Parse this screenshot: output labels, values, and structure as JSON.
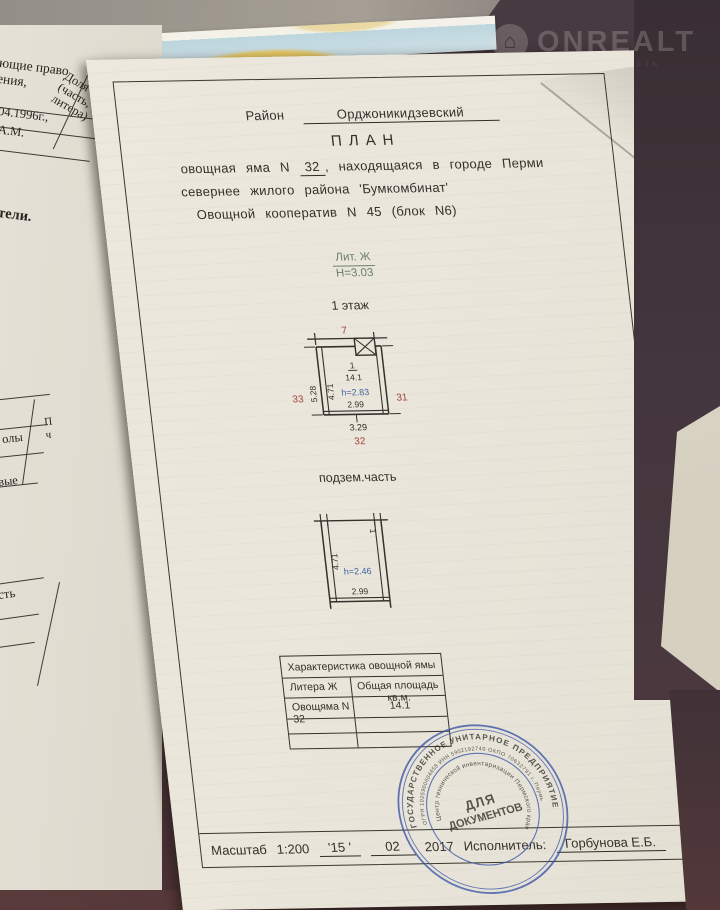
{
  "watermark": {
    "brand": "ONREALT",
    "tagline": "недвижимость",
    "icon": "house-icon"
  },
  "underlay": {
    "f_pravo": "ющие право\nения,",
    "f_dolya": "Доля\n(часть,\nлитера)",
    "f_date": "04.1996г.,",
    "f_am": "А.М.",
    "f_teli": "тели.",
    "f_p": "П\nч",
    "f_oly": "олы",
    "f_vye": "вые",
    "f_st": "сть"
  },
  "doc": {
    "district_label": "Район",
    "district_value": "Орджоникидзевский",
    "title": "ПЛАН",
    "line1_pre": "овощная яма N",
    "line1_num": "32",
    "line1_post": ", находящаяся в городе Перми",
    "line2": "севернее жилого района 'Бумкомбинат'",
    "line3": "Овощной кооператив N 45 (блок N6)",
    "liter": {
      "label": "Лит. Ж",
      "height": "Н=3.03"
    },
    "floor_label": "1 этаж",
    "plan1": {
      "top": "7",
      "left_outer": "5.28",
      "left_inner": "4.71",
      "room": "1",
      "area": "14.1",
      "h": "h=2.83",
      "width_inner": "2.99",
      "width_outer": "3.29",
      "n_left": "33",
      "n_right": "31",
      "n_bottom": "32"
    },
    "underground_label": "подзем.часть",
    "plan2": {
      "room": "1",
      "left": "4.71",
      "h": "h=2.46",
      "width": "2.99"
    },
    "table": {
      "title": "Характеристика овощной ямы",
      "col1": "Литера Ж",
      "col2": "Общая площадь кв.м.",
      "row1_name": "Овощяма N 32",
      "row1_area": "14.1"
    },
    "stamp": {
      "ring_outer": "ГОСУДАРСТВЕННОЕ УНИТАРНОЕ ПРЕДПРИЯТИЕ",
      "ring_numbers": "ОГРН 1025900604658 ИНН 5902192740 ОКПО 70632791 г. Пермь",
      "ring_inner": "Центр технической инвентаризации Пермского края",
      "center1": "ДЛЯ",
      "center2": "ДОКУМЕНТОВ"
    },
    "footer": {
      "scale_label": "Масштаб",
      "scale": "1:200",
      "day": "'15 '",
      "month": "02",
      "year": "2017",
      "executor_label": "Исполнитель:",
      "executor": "Горбунова Е.Б."
    }
  },
  "colors": {
    "red": "#a2403a",
    "blue": "#3f68a0",
    "green": "#6b7f70",
    "stamp_blue": "#3d58a8",
    "ink": "#33312b"
  }
}
